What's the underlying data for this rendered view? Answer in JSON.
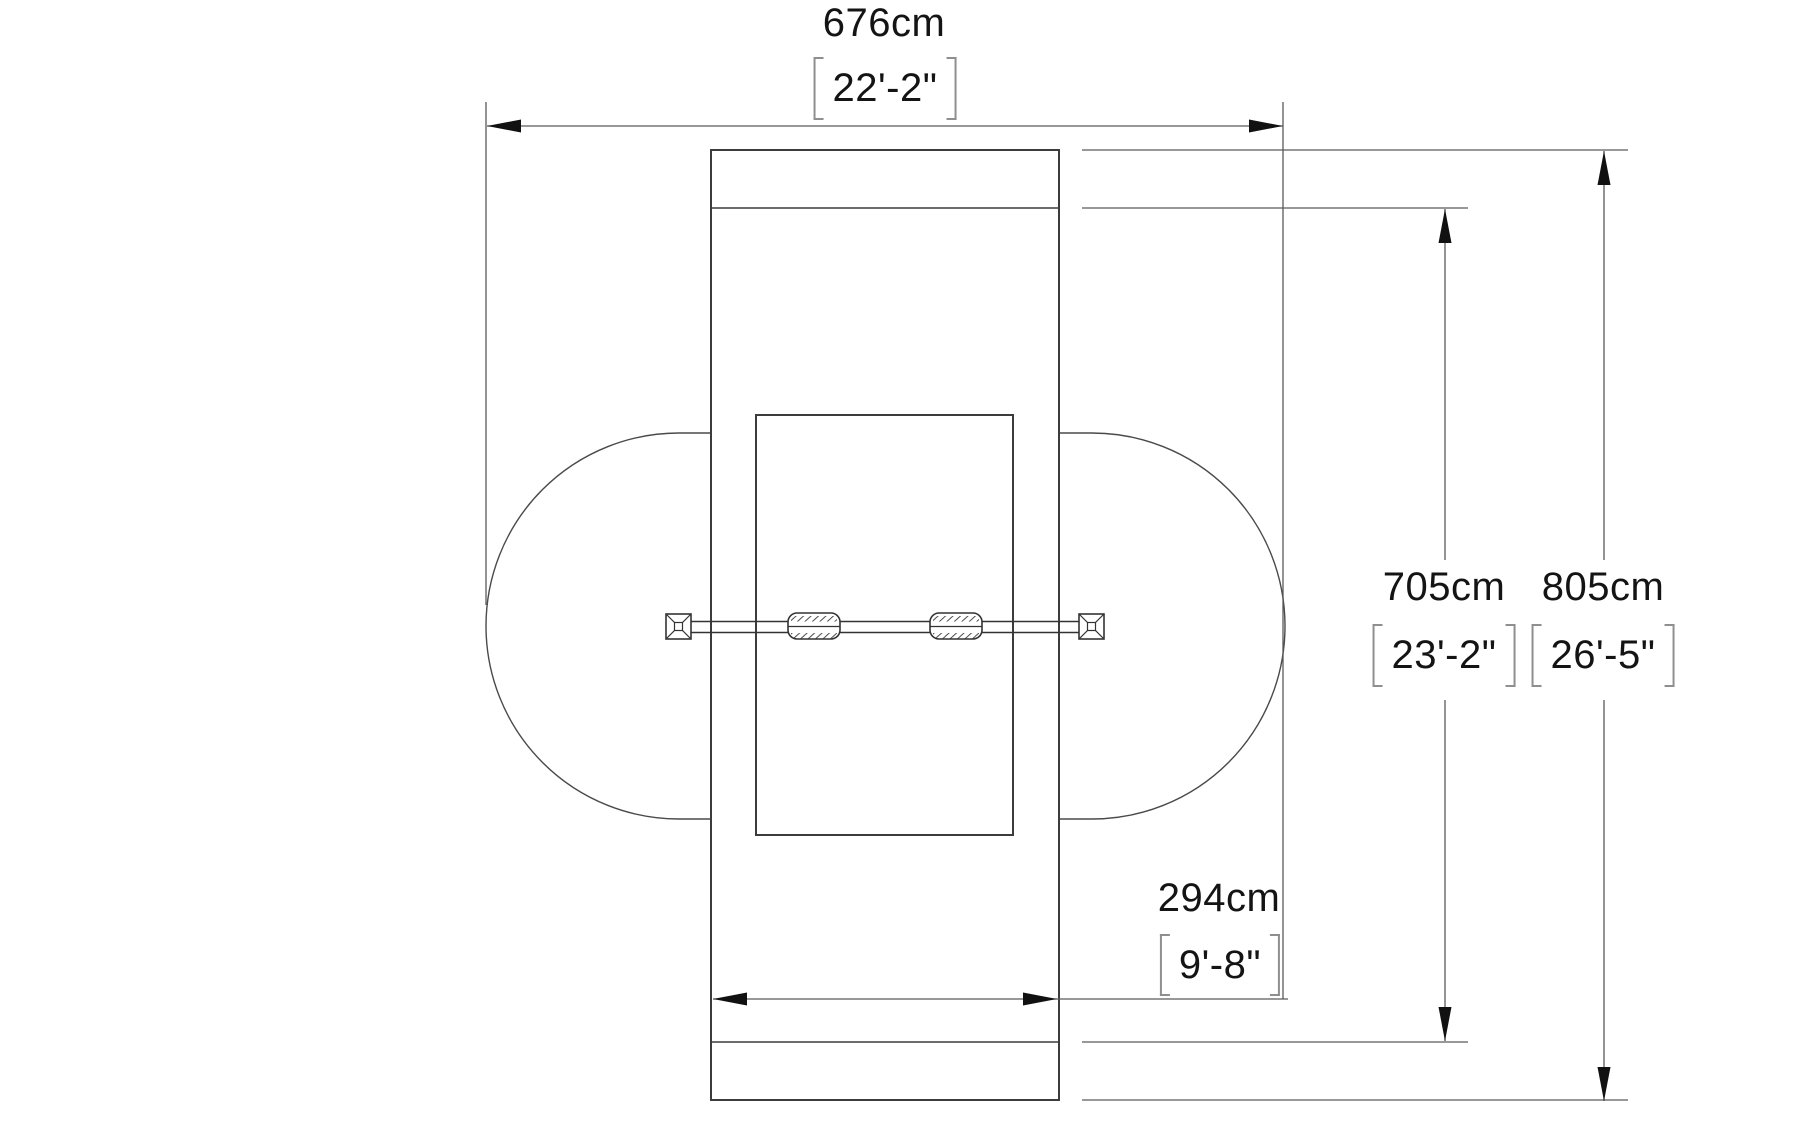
{
  "drawing": {
    "type": "plan-view-dimension-drawing",
    "background_color": "#ffffff",
    "outline_color": "#3c3c3c",
    "dimension_line_color": "#5a5a5a",
    "arrow_color": "#111111",
    "text_color": "#141414",
    "bracket_color": "#8f8f8f"
  },
  "dimensions": {
    "top_width": {
      "metric": "676cm",
      "imperial": "22'-2\""
    },
    "inner_height": {
      "metric": "705cm",
      "imperial": "23'-2\""
    },
    "outer_height": {
      "metric": "805cm",
      "imperial": "26'-5\""
    },
    "bottom_width": {
      "metric": "294cm",
      "imperial": "9'-8\""
    }
  }
}
